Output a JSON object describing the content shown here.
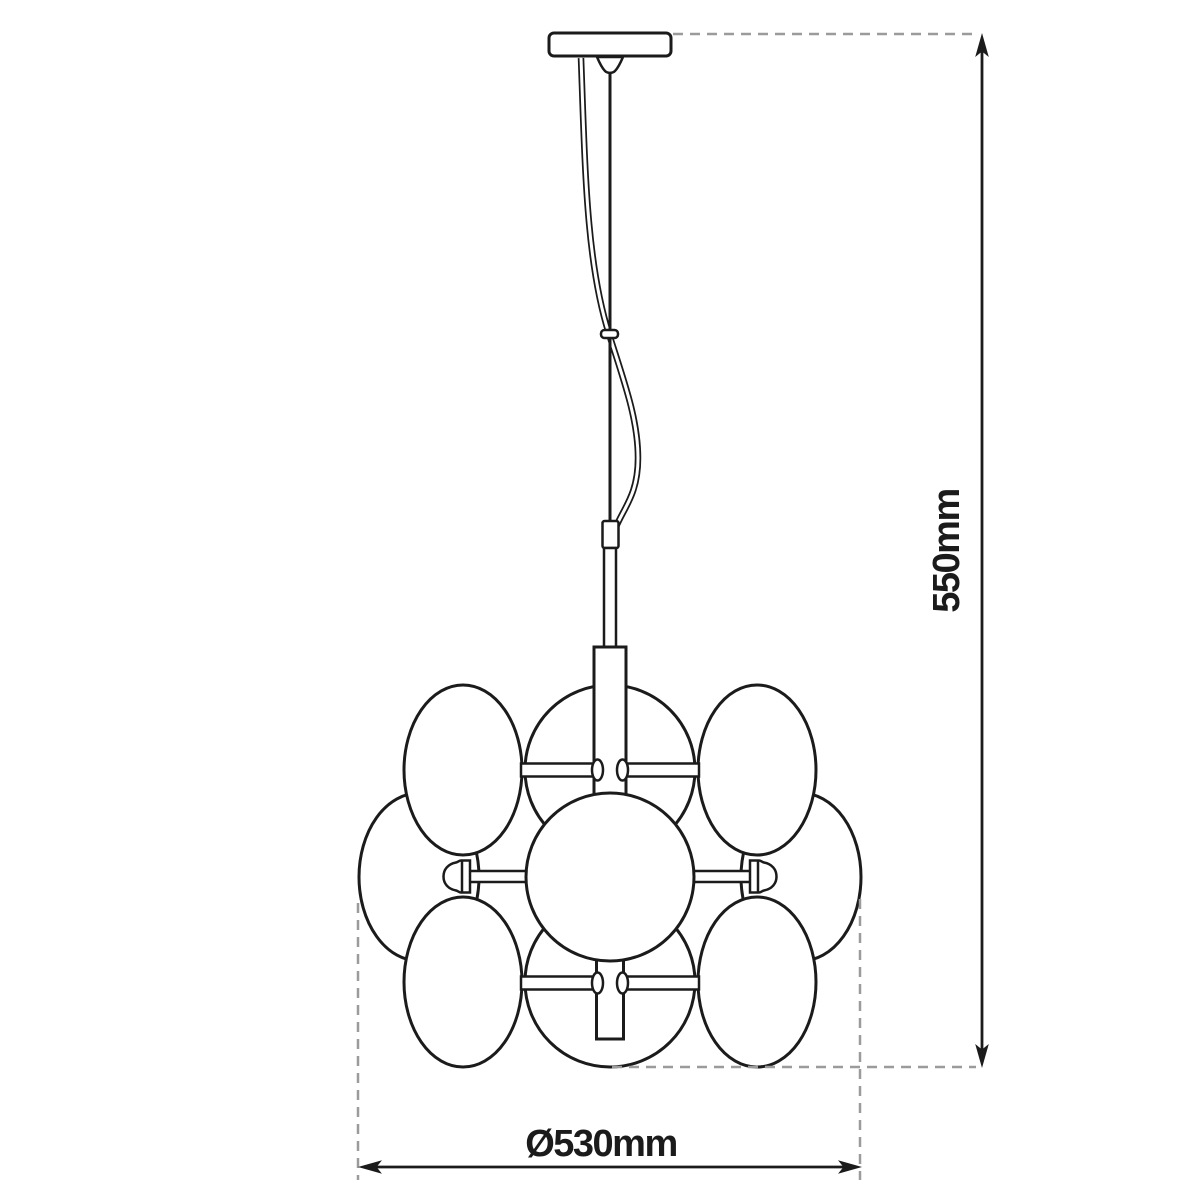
{
  "diagram": {
    "title": "pendant-lamp-dimension-drawing",
    "colors": {
      "line": "#1b1b1b",
      "dash": "#9b9b9b",
      "background": "#ffffff"
    },
    "dimensions": {
      "height": {
        "label": "550mm"
      },
      "diameter": {
        "label": "Ø530mm"
      }
    }
  }
}
